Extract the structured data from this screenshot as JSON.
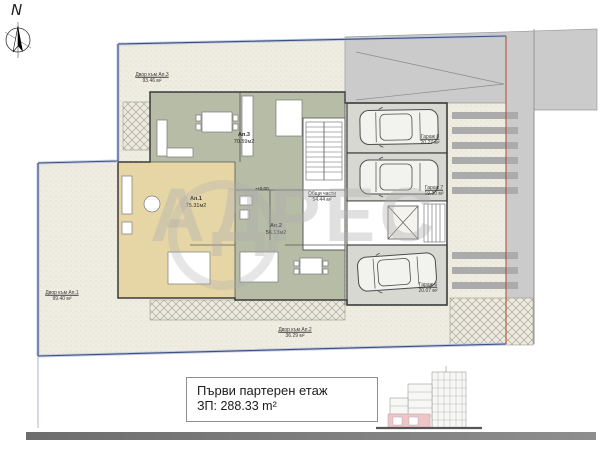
{
  "compass": {
    "label": "N"
  },
  "watermark": {
    "text": "АДРЕС"
  },
  "plan": {
    "yards": [
      {
        "name": "Двор към Ап.3",
        "area": "93.46 м²"
      },
      {
        "name": "Двор към Ап.1",
        "area": "99.40 м²"
      },
      {
        "name": "Двор към Ап.2",
        "area": "36.29 м²"
      }
    ],
    "apartments": [
      {
        "name": "Ап.3",
        "area": "70.59м2"
      },
      {
        "name": "Ап.1",
        "area": "75.31м2"
      },
      {
        "name": "Ап.2",
        "area": "56.13м2"
      }
    ],
    "common_area": {
      "name": "Общи части",
      "area": "54.44 м²"
    },
    "level_mark": "+0.00",
    "garages": [
      {
        "name": "Гараж 8",
        "area": "20.27 м²"
      },
      {
        "name": "Гараж 7",
        "area": "19.30 м²"
      },
      {
        "name": "Гараж 6",
        "area": "20.07 м²"
      }
    ]
  },
  "caption": {
    "title": "Първи партерен етаж",
    "area": "ЗП: 288.33 m²"
  }
}
